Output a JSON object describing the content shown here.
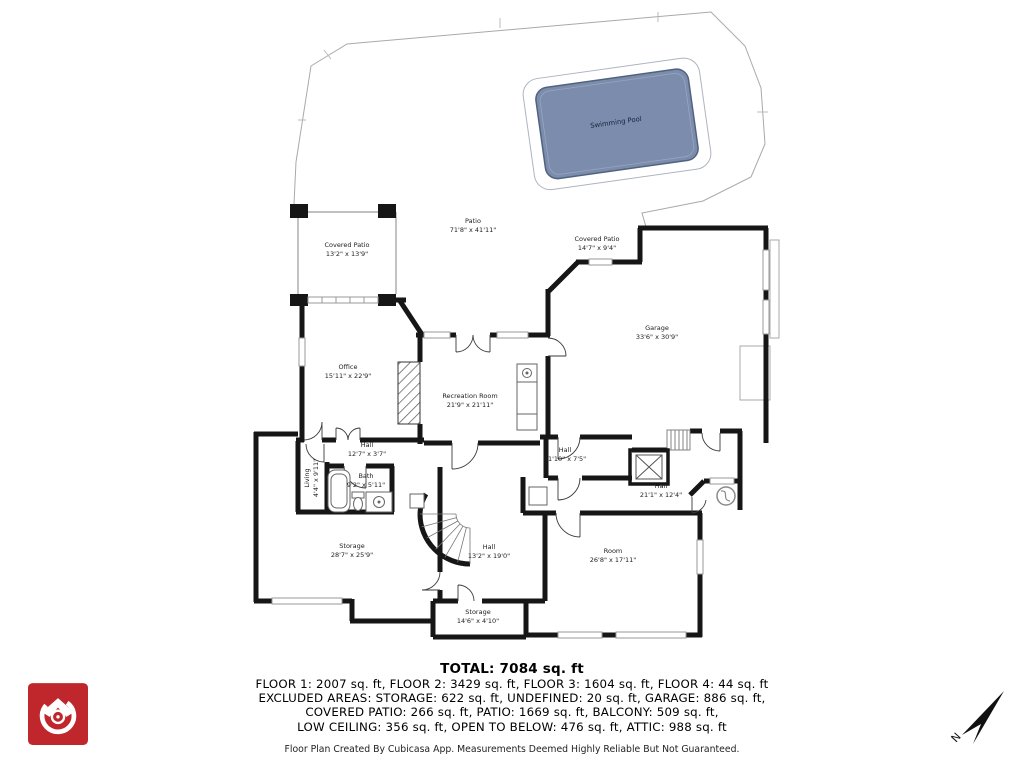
{
  "rooms": [
    {
      "name": "Swimming Pool",
      "dims": ""
    },
    {
      "name": "Patio",
      "dims": "71'8\" x 41'11\""
    },
    {
      "name": "Covered Patio",
      "dims": "13'2\" x 13'9\""
    },
    {
      "name": "Covered Patio",
      "dims": "14'7\" x 9'4\""
    },
    {
      "name": "Garage",
      "dims": "33'6\" x 30'9\""
    },
    {
      "name": "Office",
      "dims": "15'11\" x 22'9\""
    },
    {
      "name": "Recreation Room",
      "dims": "21'9\" x 21'11\""
    },
    {
      "name": "Hall",
      "dims": "12'7\" x 3'7\""
    },
    {
      "name": "Living",
      "dims": "4'4\" x 9'11\""
    },
    {
      "name": "Bath",
      "dims": "9'2\" x 5'11\""
    },
    {
      "name": "Hall",
      "dims": "11'10\" x 7'5\""
    },
    {
      "name": "Hall",
      "dims": "21'1\" x 12'4\""
    },
    {
      "name": "Storage",
      "dims": "28'7\" x 25'9\""
    },
    {
      "name": "Hall",
      "dims": "13'2\" x 19'0\""
    },
    {
      "name": "Room",
      "dims": "26'8\" x 17'11\""
    },
    {
      "name": "Storage",
      "dims": "14'6\" x 4'10\""
    }
  ],
  "summary": {
    "total": "TOTAL: 7084 sq. ft",
    "lines": [
      "FLOOR 1: 2007 sq. ft, FLOOR 2: 3429 sq. ft, FLOOR 3: 1604 sq. ft, FLOOR 4: 44 sq. ft",
      "EXCLUDED AREAS: STORAGE: 622 sq. ft, UNDEFINED: 20 sq. ft, GARAGE: 886 sq. ft,",
      "COVERED PATIO: 266 sq. ft, PATIO: 1669 sq. ft, BALCONY: 509 sq. ft,",
      "LOW CEILING: 356 sq. ft, OPEN TO BELOW: 476 sq. ft, ATTIC: 988 sq. ft"
    ],
    "footer": "Floor Plan Created By Cubicasa App. Measurements Deemed Highly Reliable But Not Guaranteed."
  },
  "compass": {
    "north_label": "N"
  },
  "colors": {
    "pool_fill": "#7B8CAD",
    "pool_border": "#51627F",
    "wall": "#161616",
    "thin_line": "#9A9A9A",
    "logo_red": "#C0272D"
  }
}
